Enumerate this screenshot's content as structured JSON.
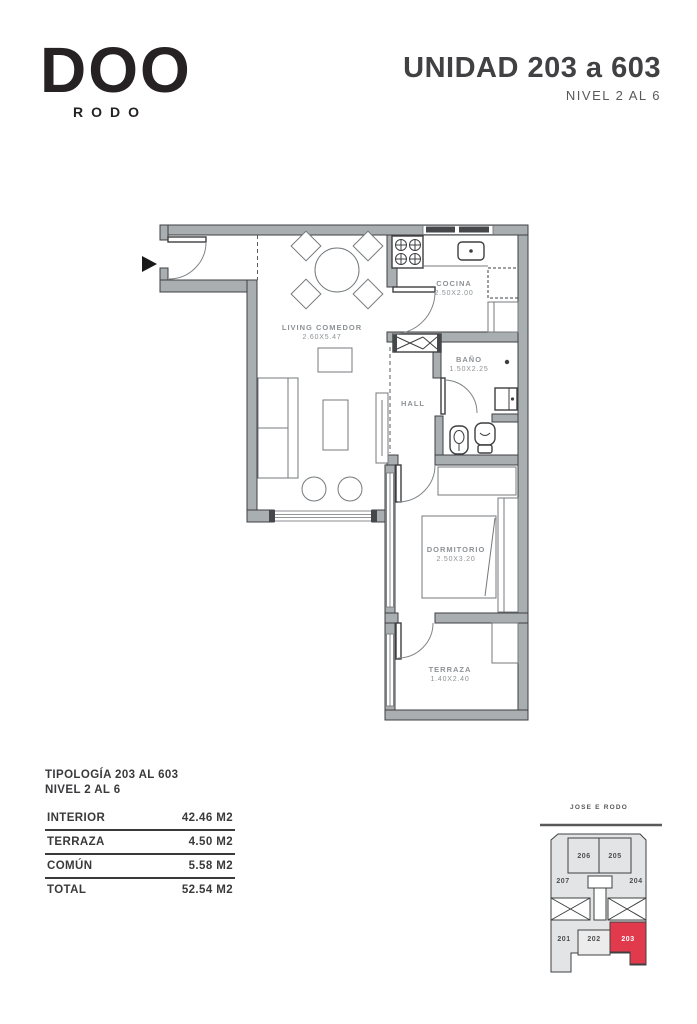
{
  "brand": {
    "logo": "DOO",
    "sub": "RODO"
  },
  "header": {
    "title": "UNIDAD 203 a 603",
    "subtitle": "NIVEL 2 AL 6"
  },
  "plan": {
    "rooms": {
      "living": {
        "name": "LIVING COMEDOR",
        "dims": "2.60X5.47"
      },
      "cocina": {
        "name": "COCINA",
        "dims": "2.50X2.00"
      },
      "bano": {
        "name": "BAÑO",
        "dims": "1.50X2.25"
      },
      "hall": {
        "name": "HALL"
      },
      "dormitorio": {
        "name": "DORMITORIO",
        "dims": "2.50X3.20"
      },
      "terraza": {
        "name": "TERRAZA",
        "dims": "1.40X2.40"
      }
    }
  },
  "areas": {
    "heading_line1": "TIPOLOGÍA 203 AL 603",
    "heading_line2": "NIVEL 2 AL 6",
    "rows": [
      {
        "label": "INTERIOR",
        "value": "42.46 M2"
      },
      {
        "label": "TERRAZA",
        "value": "4.50 M2"
      },
      {
        "label": "COMÚN",
        "value": "5.58 M2"
      },
      {
        "label": "TOTAL",
        "value": "52.54 M2"
      }
    ]
  },
  "keyplan": {
    "street": "JOSE E RODO",
    "units": [
      "206",
      "205",
      "207",
      "204",
      "201",
      "202",
      "203"
    ],
    "highlight": "203",
    "highlight_color": "#e13a4d"
  }
}
